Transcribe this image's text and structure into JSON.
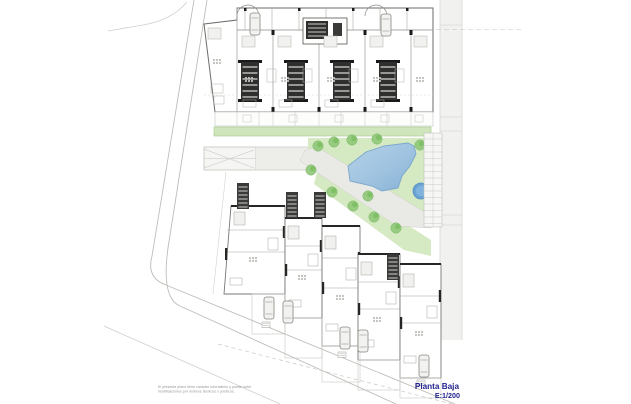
{
  "title_block": {
    "plan_name": "Planta Baja",
    "scale": "E:1/200",
    "text_color": "#22228e"
  },
  "disclaimer": {
    "line1": "El presente plano tiene carácter informativo y puede sufrir",
    "line2": "modificaciones por motivos técnicos o jurídicos."
  },
  "plan": {
    "colors": {
      "page": "#ffffff",
      "lawn": "#d5e9c2",
      "hedge": "#cfe5bb",
      "tree": "#93ca7d",
      "pool": "#a9c9e4",
      "pool_deep": "#8fb6d9",
      "round_pool": "#6aa2d4",
      "road": "#f1f1ef",
      "path": "#e9e9e6",
      "wall_dark": "#2f2f2d",
      "line_gray": "#a5a5a0",
      "curb_gray": "#bdbdb9"
    }
  }
}
